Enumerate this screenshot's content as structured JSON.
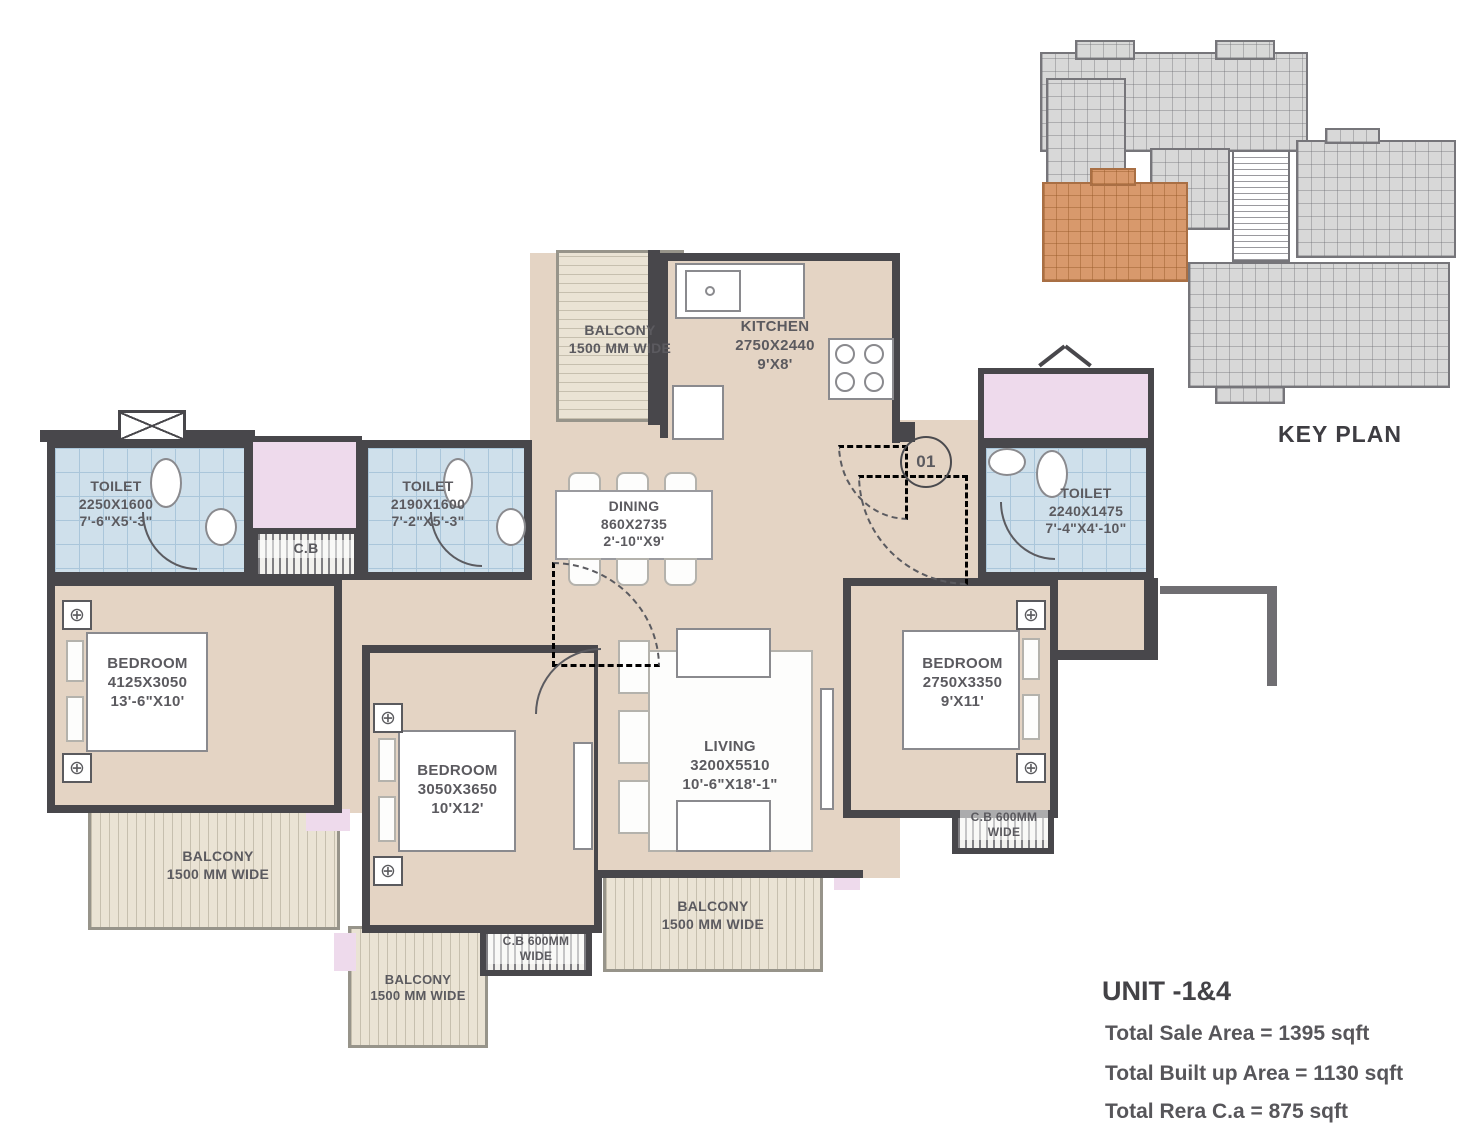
{
  "unit": {
    "title": "UNIT -1&4",
    "sale": "Total Sale Area = 1395 sqft",
    "built": "Total Built up Area = 1130 sqft",
    "rera": "Total Rera C.a = 875 sqft"
  },
  "key_plan": {
    "label": "KEY PLAN"
  },
  "entrance": {
    "number": "01"
  },
  "icons": {
    "fan": "⊕"
  },
  "rooms": {
    "toilet_left": {
      "name": "TOILET",
      "mm": "2250X1600",
      "ft": "7'-6\"X5'-3\""
    },
    "toilet_mid": {
      "name": "TOILET",
      "mm": "2190X1600",
      "ft": "7'-2\"X5'-3\""
    },
    "toilet_right": {
      "name": "TOILET",
      "mm": "2240X1475",
      "ft": "7'-4\"X4'-10\""
    },
    "kitchen": {
      "name": "KITCHEN",
      "mm": "2750X2440",
      "ft": "9'X8'"
    },
    "dining": {
      "name": "DINING",
      "mm": "860X2735",
      "ft": "2'-10\"X9'"
    },
    "living": {
      "name": "LIVING",
      "mm": "3200X5510",
      "ft": "10'-6\"X18'-1\""
    },
    "bedroom_left": {
      "name": "BEDROOM",
      "mm": "4125X3050",
      "ft": "13'-6\"X10'"
    },
    "bedroom_mid": {
      "name": "BEDROOM",
      "mm": "3050X3650",
      "ft": "10'X12'"
    },
    "bedroom_right": {
      "name": "BEDROOM",
      "mm": "2750X3350",
      "ft": "9'X11'"
    }
  },
  "balconies": {
    "top": {
      "name": "BALCONY",
      "width": "1500 MM WIDE"
    },
    "left": {
      "name": "BALCONY",
      "width": "1500 MM WIDE"
    },
    "bottom": {
      "name": "BALCONY",
      "width": "1500 MM WIDE"
    },
    "mid": {
      "name": "BALCONY",
      "width": "1500 MM WIDE"
    }
  },
  "ducts": {
    "cb": "C.B",
    "cb600_bottom": "C.B 600MM WIDE",
    "cb600_right": "C.B 600MM WIDE"
  },
  "colors": {
    "wall": "#48474b",
    "floor": "#e4d4c4",
    "tile": "#cfe0eb",
    "shaft_pink": "#eedaec",
    "balcony": "#eae3d4",
    "keyplan_unit_orange": "#d8996c"
  }
}
